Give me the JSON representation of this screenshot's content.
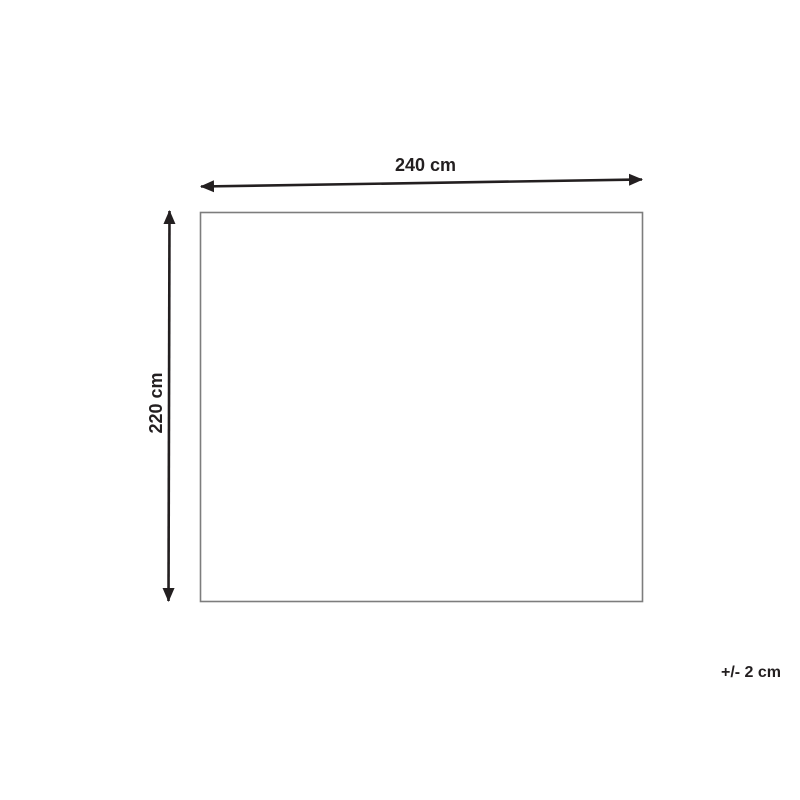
{
  "diagram": {
    "title": "product-dimension-diagram",
    "width_label": "240 cm",
    "height_label": "220 cm",
    "tolerance_label": "+/- 2 cm"
  },
  "colors": {
    "ink": "#231f20",
    "outline": "#7d7d7d",
    "background": "#ffffff"
  }
}
